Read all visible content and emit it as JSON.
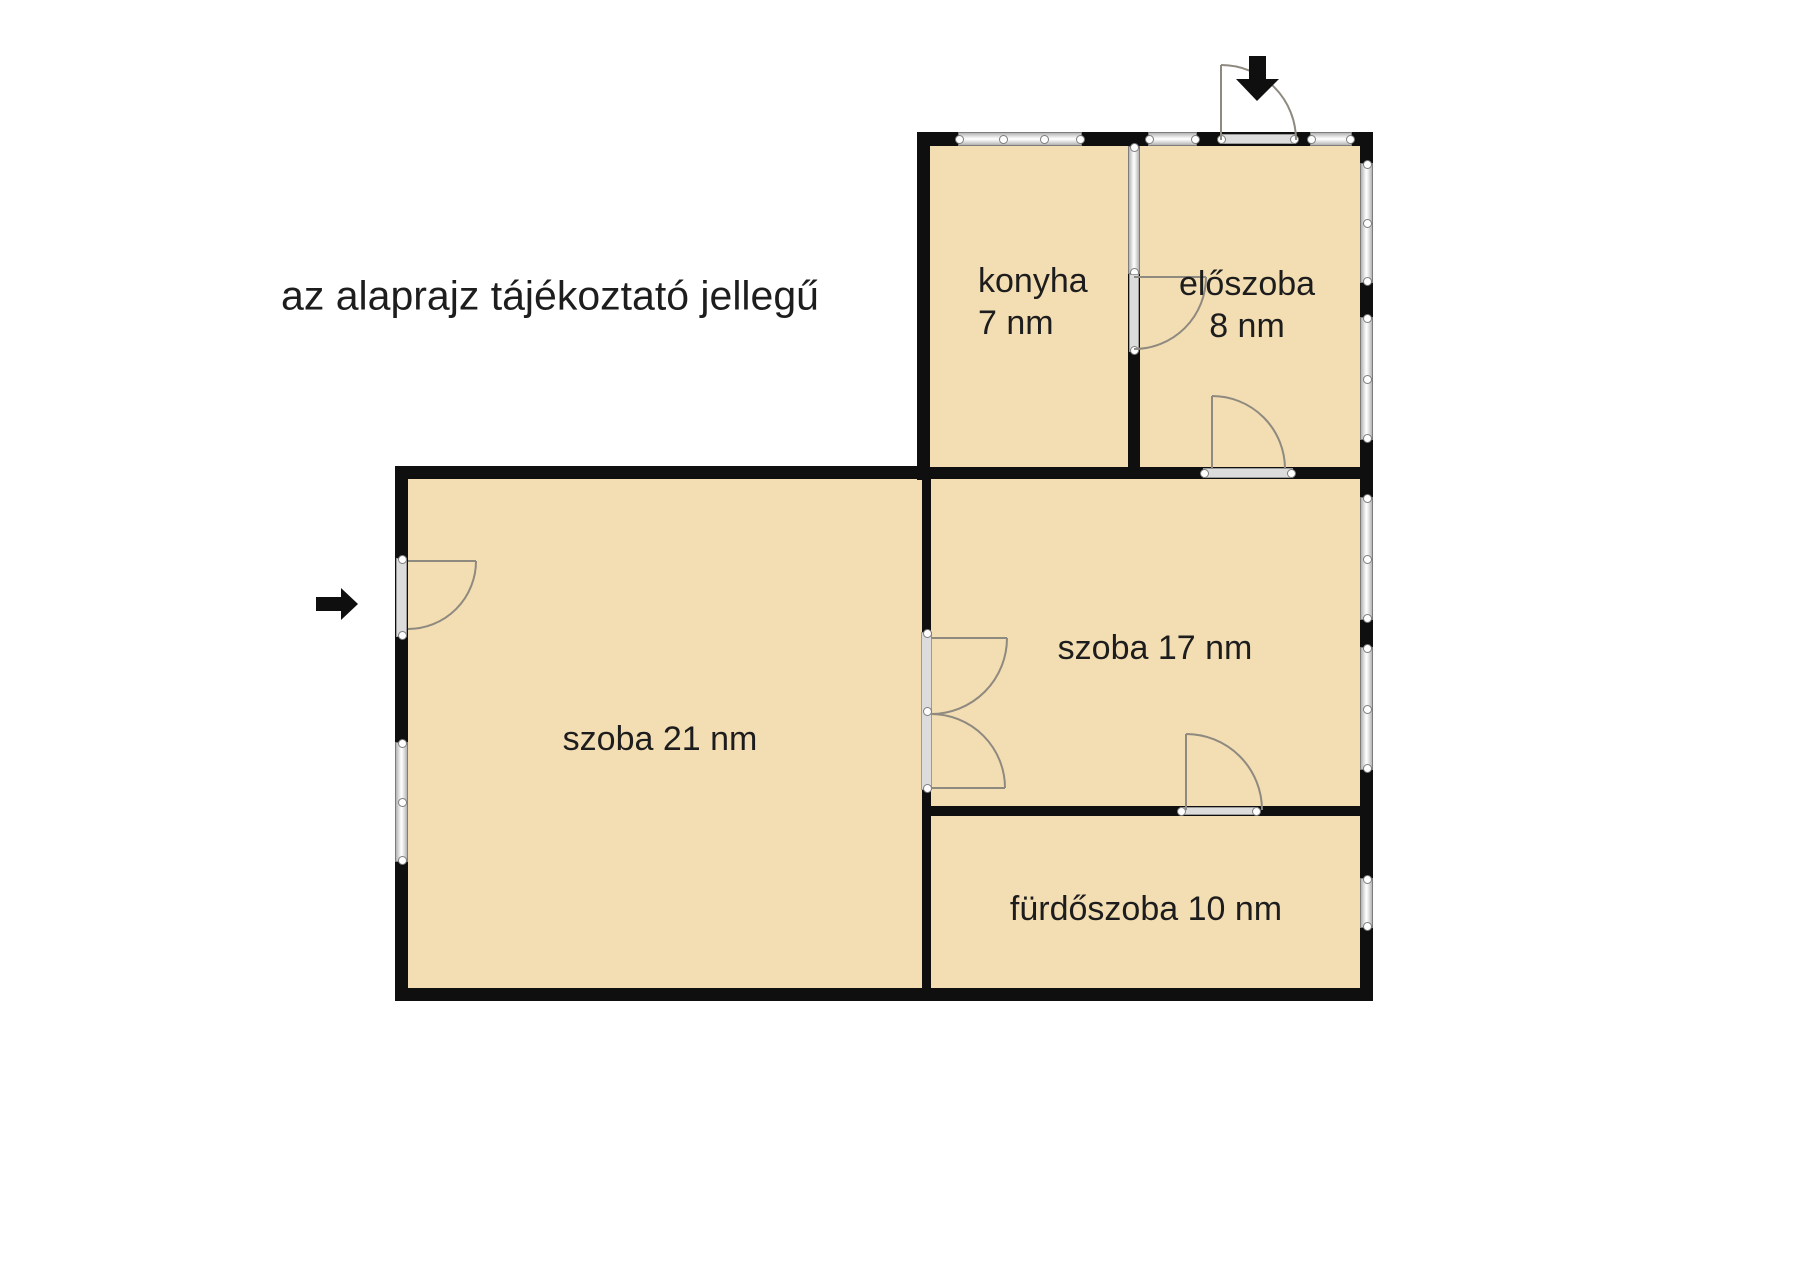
{
  "disclaimer": "az alaprajz tájékoztató jellegű",
  "rooms": {
    "konyha": {
      "name": "konyha",
      "area": "7 nm"
    },
    "eloszoba": {
      "name": "előszoba",
      "area": "8 nm"
    },
    "szoba17": {
      "label": "szoba 17 nm"
    },
    "szoba21": {
      "label": "szoba 21 nm"
    },
    "furdoszoba": {
      "label": "fürdőszoba 10 nm"
    }
  },
  "colors": {
    "wall": "#0f0f0f",
    "floor": "#f3ddb3",
    "window-border": "#7d7d7d",
    "door-line": "#8f8a80",
    "text": "#1d1d1d"
  }
}
